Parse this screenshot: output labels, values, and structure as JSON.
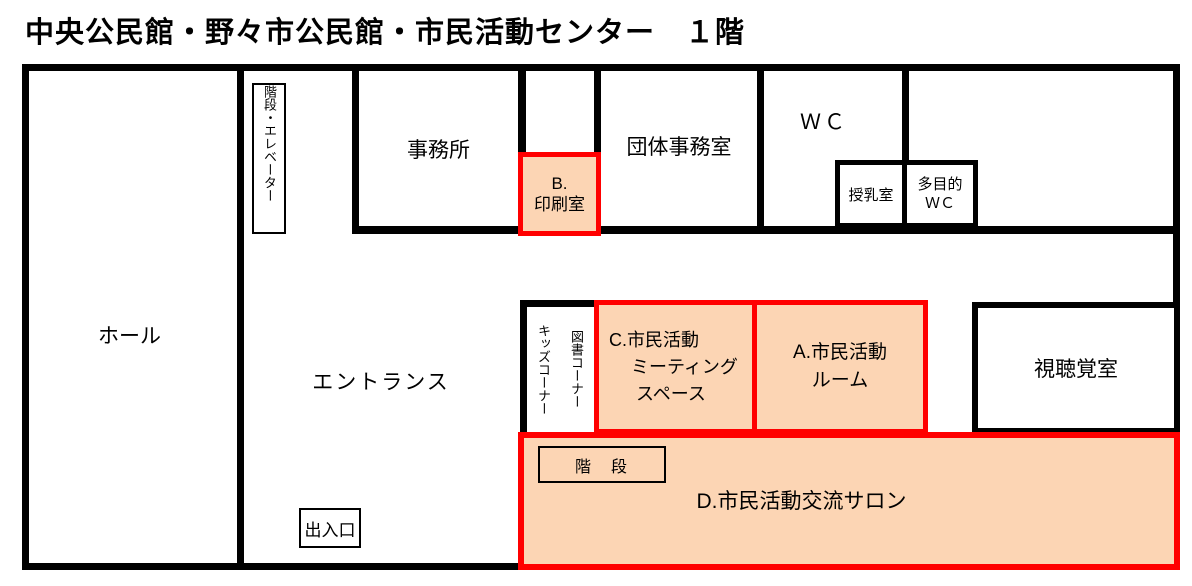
{
  "title": "中央公民館・野々市公民館・市民活動センター　１階",
  "colors": {
    "wall": "#000000",
    "highlight_border": "#FF0000",
    "highlight_fill": "#FCD5B4",
    "background": "#FFFFFF"
  },
  "rooms": {
    "hall": "ホール",
    "stairs_elevator": "階段・エレベーター",
    "office": "事務所",
    "print_room": {
      "line1": "B.",
      "line2": "印刷室"
    },
    "group_office": "団体事務室",
    "wc": "ＷＣ",
    "nursing_room": "授乳室",
    "multipurpose_wc": {
      "line1": "多目的",
      "line2": "ＷＣ"
    },
    "entrance_hall": "エントランス",
    "book_corner": "図書コーナー",
    "kids_corner": "キッズコーナー",
    "meeting_space": {
      "line1": "C.市民活動",
      "line2": "ミーティング",
      "line3": "スペース"
    },
    "activity_room": {
      "line1": "A.市民活動",
      "line2": "ルーム"
    },
    "av_room": "視聴覚室",
    "inner_stairs": "階　段",
    "salon": "D.市民活動交流サロン",
    "exit": "出入口"
  }
}
